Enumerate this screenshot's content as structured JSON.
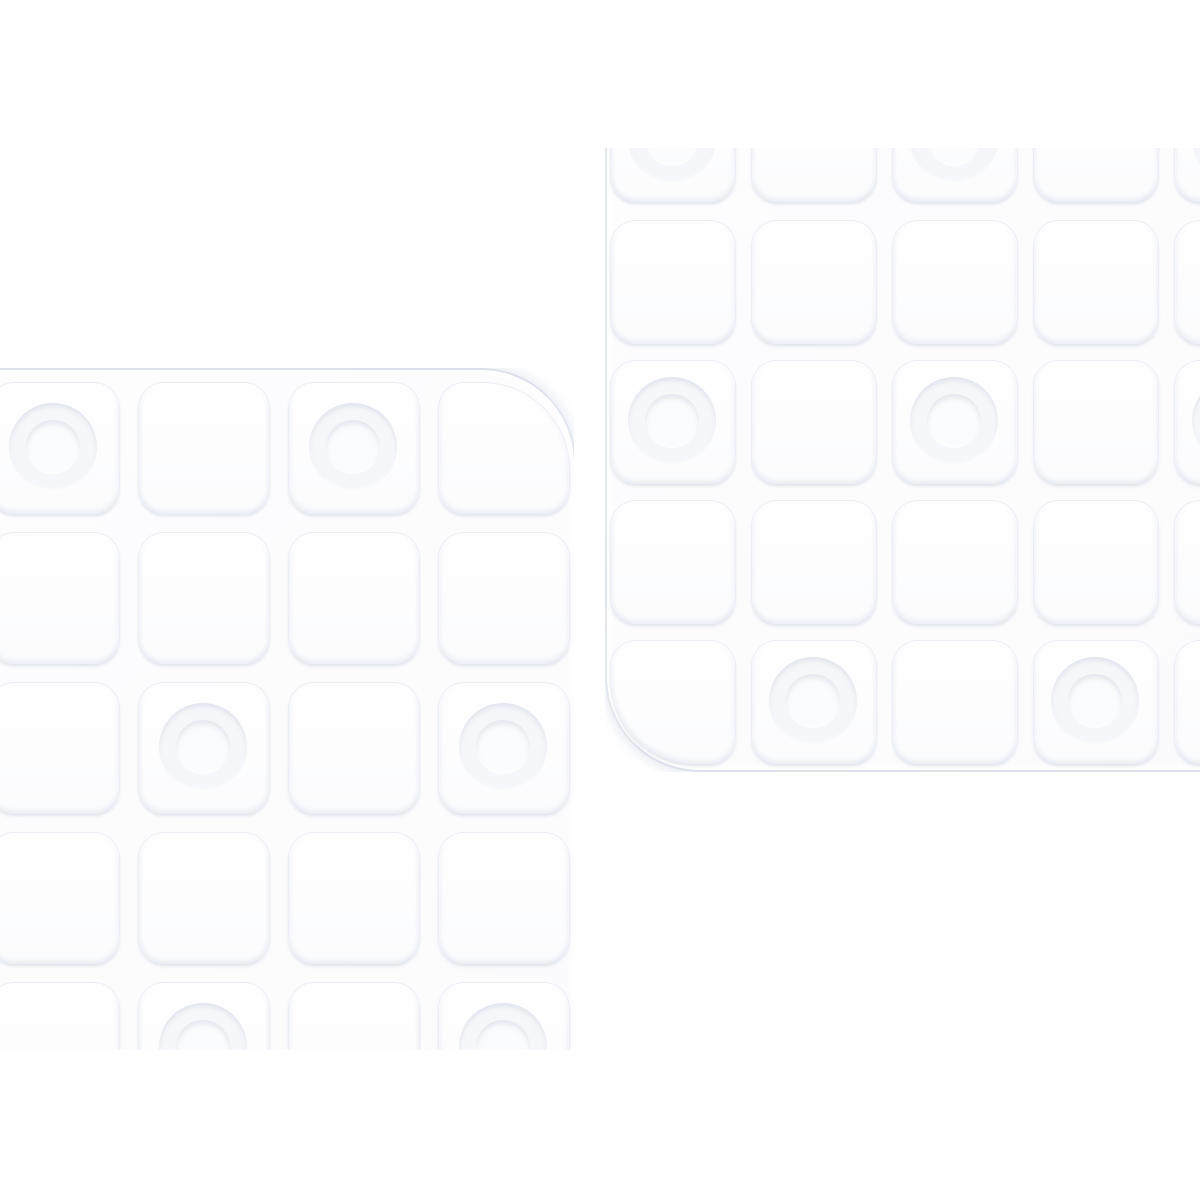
{
  "scene": {
    "description": "Two overlapping-diagonal detail views of a transparent anti-slip shower mat with an embossed grid of rounded squares and circular suction cups, on a plain white background",
    "background_color": "#ffffff",
    "colors": {
      "mat_base": "#fcfcfd",
      "cell_fill": "#fdfdfe",
      "edge_line": "#d4d9e5",
      "cell_shadow": "#cbd0de",
      "cup_ring": "#e6e9f0"
    }
  },
  "cup": {
    "outer_d": 88,
    "inner_d": 54
  },
  "mats": [
    {
      "name": "shower-mat-top-right",
      "clip": {
        "left": 605,
        "top": 148,
        "width": 595,
        "height": 624
      },
      "body": {
        "left": 605,
        "top": 68,
        "width": 650,
        "height": 702,
        "radius": "0 0 0 95px",
        "corner_class": "corner-bl"
      },
      "grid": {
        "cols_x": [
          610,
          751,
          892,
          1033,
          1174
        ],
        "rows_y": [
          78,
          220,
          360,
          500,
          640
        ],
        "cell_w": 124,
        "cell_h": 122,
        "cell_radius": "26px",
        "corner_cell": {
          "row": 4,
          "col": 0,
          "radius": "26px 26px 26px 85px"
        }
      },
      "cups": [
        {
          "row": 0,
          "col": 0
        },
        {
          "row": 0,
          "col": 2
        },
        {
          "row": 0,
          "col": 4
        },
        {
          "row": 2,
          "col": 0
        },
        {
          "row": 2,
          "col": 2
        },
        {
          "row": 2,
          "col": 4
        },
        {
          "row": 4,
          "col": 1
        },
        {
          "row": 4,
          "col": 3
        }
      ]
    },
    {
      "name": "shower-mat-bottom-left",
      "clip": {
        "left": 0,
        "top": 368,
        "width": 574,
        "height": 682
      },
      "body": {
        "left": -60,
        "top": 368,
        "width": 634,
        "height": 742,
        "radius": "0 95px 0 0",
        "corner_class": "corner-tr"
      },
      "grid": {
        "cols_x": [
          -12,
          138,
          288,
          438
        ],
        "rows_y": [
          382,
          532,
          682,
          832,
          982
        ],
        "cell_w": 130,
        "cell_h": 130,
        "cell_radius": "26px",
        "corner_cell": {
          "row": 0,
          "col": 3,
          "radius": "26px 88px 26px 26px"
        }
      },
      "cups": [
        {
          "row": 0,
          "col": 0
        },
        {
          "row": 0,
          "col": 2
        },
        {
          "row": 2,
          "col": 1
        },
        {
          "row": 2,
          "col": 3
        },
        {
          "row": 4,
          "col": 1
        },
        {
          "row": 4,
          "col": 3
        }
      ]
    }
  ]
}
